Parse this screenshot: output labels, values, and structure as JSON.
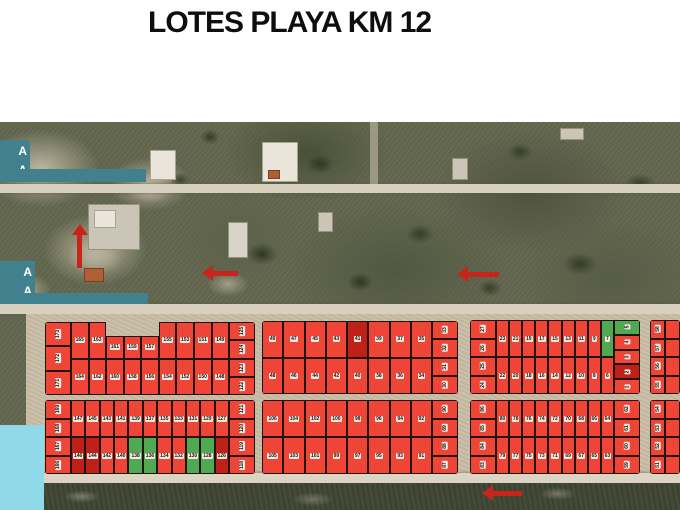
{
  "title": "LOTES PLAYA KM 12",
  "map": {
    "colors": {
      "lot_red": "#ee4537",
      "lot_green": "#4fa852",
      "lot_dark_red": "#bf2018",
      "label_teal": "#41808d",
      "cyan_box": "#90d9e8",
      "arrow_red": "#c9241b"
    },
    "side_labels": [
      {
        "lines": [
          "A",
          "A"
        ]
      },
      {
        "lines": [
          "A",
          "A"
        ]
      }
    ],
    "blocks": [
      {
        "id": "A1",
        "x": 45,
        "y": 200,
        "w": 210,
        "h": 73,
        "left": [
          "173",
          "172",
          "171"
        ],
        "rows": [
          [
            "165",
            "163",
            {
              "n": "161",
              "lo": 1
            },
            {
              "n": "159",
              "lo": 1
            },
            {
              "n": "157",
              "lo": 1
            },
            "155",
            "153",
            "151",
            "149"
          ],
          [
            "164",
            "162",
            "160",
            "158",
            "156",
            "154",
            "152",
            "150",
            "148"
          ]
        ],
        "right": [
          "125",
          "124",
          "123",
          "122"
        ]
      },
      {
        "id": "A2",
        "x": 262,
        "y": 199,
        "w": 196,
        "h": 73,
        "rows": [
          [
            "49",
            "47",
            "45",
            "43",
            {
              "n": "41",
              "c": "dark"
            },
            "39",
            "37",
            "35"
          ],
          [
            "48",
            "46",
            "44",
            "42",
            "40",
            "38",
            "36",
            "34"
          ]
        ],
        "right": [
          "33",
          "32",
          "31",
          "30"
        ]
      },
      {
        "id": "A3",
        "x": 470,
        "y": 198,
        "w": 170,
        "h": 74,
        "left": [
          "27",
          "26",
          "25",
          "24"
        ],
        "rows": [
          [
            "23",
            "21",
            "19",
            "17",
            "15",
            "13",
            "11",
            "9",
            {
              "n": "7",
              "c": "green"
            }
          ],
          [
            "22",
            "20",
            "18",
            "16",
            "14",
            "12",
            "10",
            "8",
            "6"
          ]
        ],
        "right": [
          {
            "n": "5",
            "c": "green"
          },
          "4",
          "3",
          {
            "n": "2",
            "c": "dark"
          },
          "1"
        ]
      },
      {
        "id": "A4",
        "x": 650,
        "y": 198,
        "w": 30,
        "h": 74,
        "left": [
          "58",
          "57",
          "56",
          "55"
        ],
        "right": [
          "",
          "",
          "",
          ""
        ]
      },
      {
        "id": "B1",
        "x": 45,
        "y": 278,
        "w": 210,
        "h": 74,
        "left": [
          "169",
          "168",
          "167",
          "166"
        ],
        "rows": [
          [
            "147",
            "145",
            "143",
            "141",
            "139",
            "137",
            "135",
            "133",
            "131",
            "129",
            "127"
          ],
          [
            {
              "n": "146",
              "c": "dark"
            },
            {
              "n": "144",
              "c": "dark"
            },
            "142",
            "140",
            {
              "n": "138",
              "c": "green"
            },
            {
              "n": "136",
              "c": "green"
            },
            "134",
            "132",
            {
              "n": "130",
              "c": "green"
            },
            {
              "n": "128",
              "c": "green"
            },
            {
              "n": "126",
              "c": "dark"
            }
          ]
        ],
        "right": [
          "121",
          "120",
          "119",
          "118"
        ]
      },
      {
        "id": "B2",
        "x": 262,
        "y": 278,
        "w": 196,
        "h": 74,
        "rows": [
          [
            "106",
            "104",
            "102",
            "100",
            "98",
            "96",
            "94",
            "92"
          ],
          [
            "105",
            "103",
            "101",
            "99",
            "97",
            "95",
            "93",
            "91"
          ]
        ],
        "right": [
          "90",
          "89",
          "88",
          "87"
        ]
      },
      {
        "id": "B3",
        "x": 470,
        "y": 278,
        "w": 170,
        "h": 74,
        "left": [
          "86",
          "85",
          "84",
          "83"
        ],
        "rows": [
          [
            "80",
            "78",
            "76",
            "74",
            "72",
            "70",
            "68",
            "66",
            "64"
          ],
          [
            "79",
            "77",
            "75",
            "73",
            "71",
            "69",
            "67",
            "65",
            "63"
          ]
        ],
        "right": [
          "62",
          "61",
          "60",
          "59"
        ]
      },
      {
        "id": "B4",
        "x": 650,
        "y": 278,
        "w": 30,
        "h": 74,
        "left": [
          "54",
          "53",
          "52",
          "51"
        ],
        "right": [
          "",
          "",
          "",
          ""
        ]
      }
    ],
    "arrows": [
      {
        "dir": "up",
        "x": 58,
        "y": 116,
        "len": 44
      },
      {
        "dir": "left",
        "x": 202,
        "y": 143,
        "len": 36
      },
      {
        "dir": "left",
        "x": 457,
        "y": 144,
        "len": 42
      },
      {
        "dir": "left",
        "x": 482,
        "y": 363,
        "len": 40
      }
    ]
  }
}
